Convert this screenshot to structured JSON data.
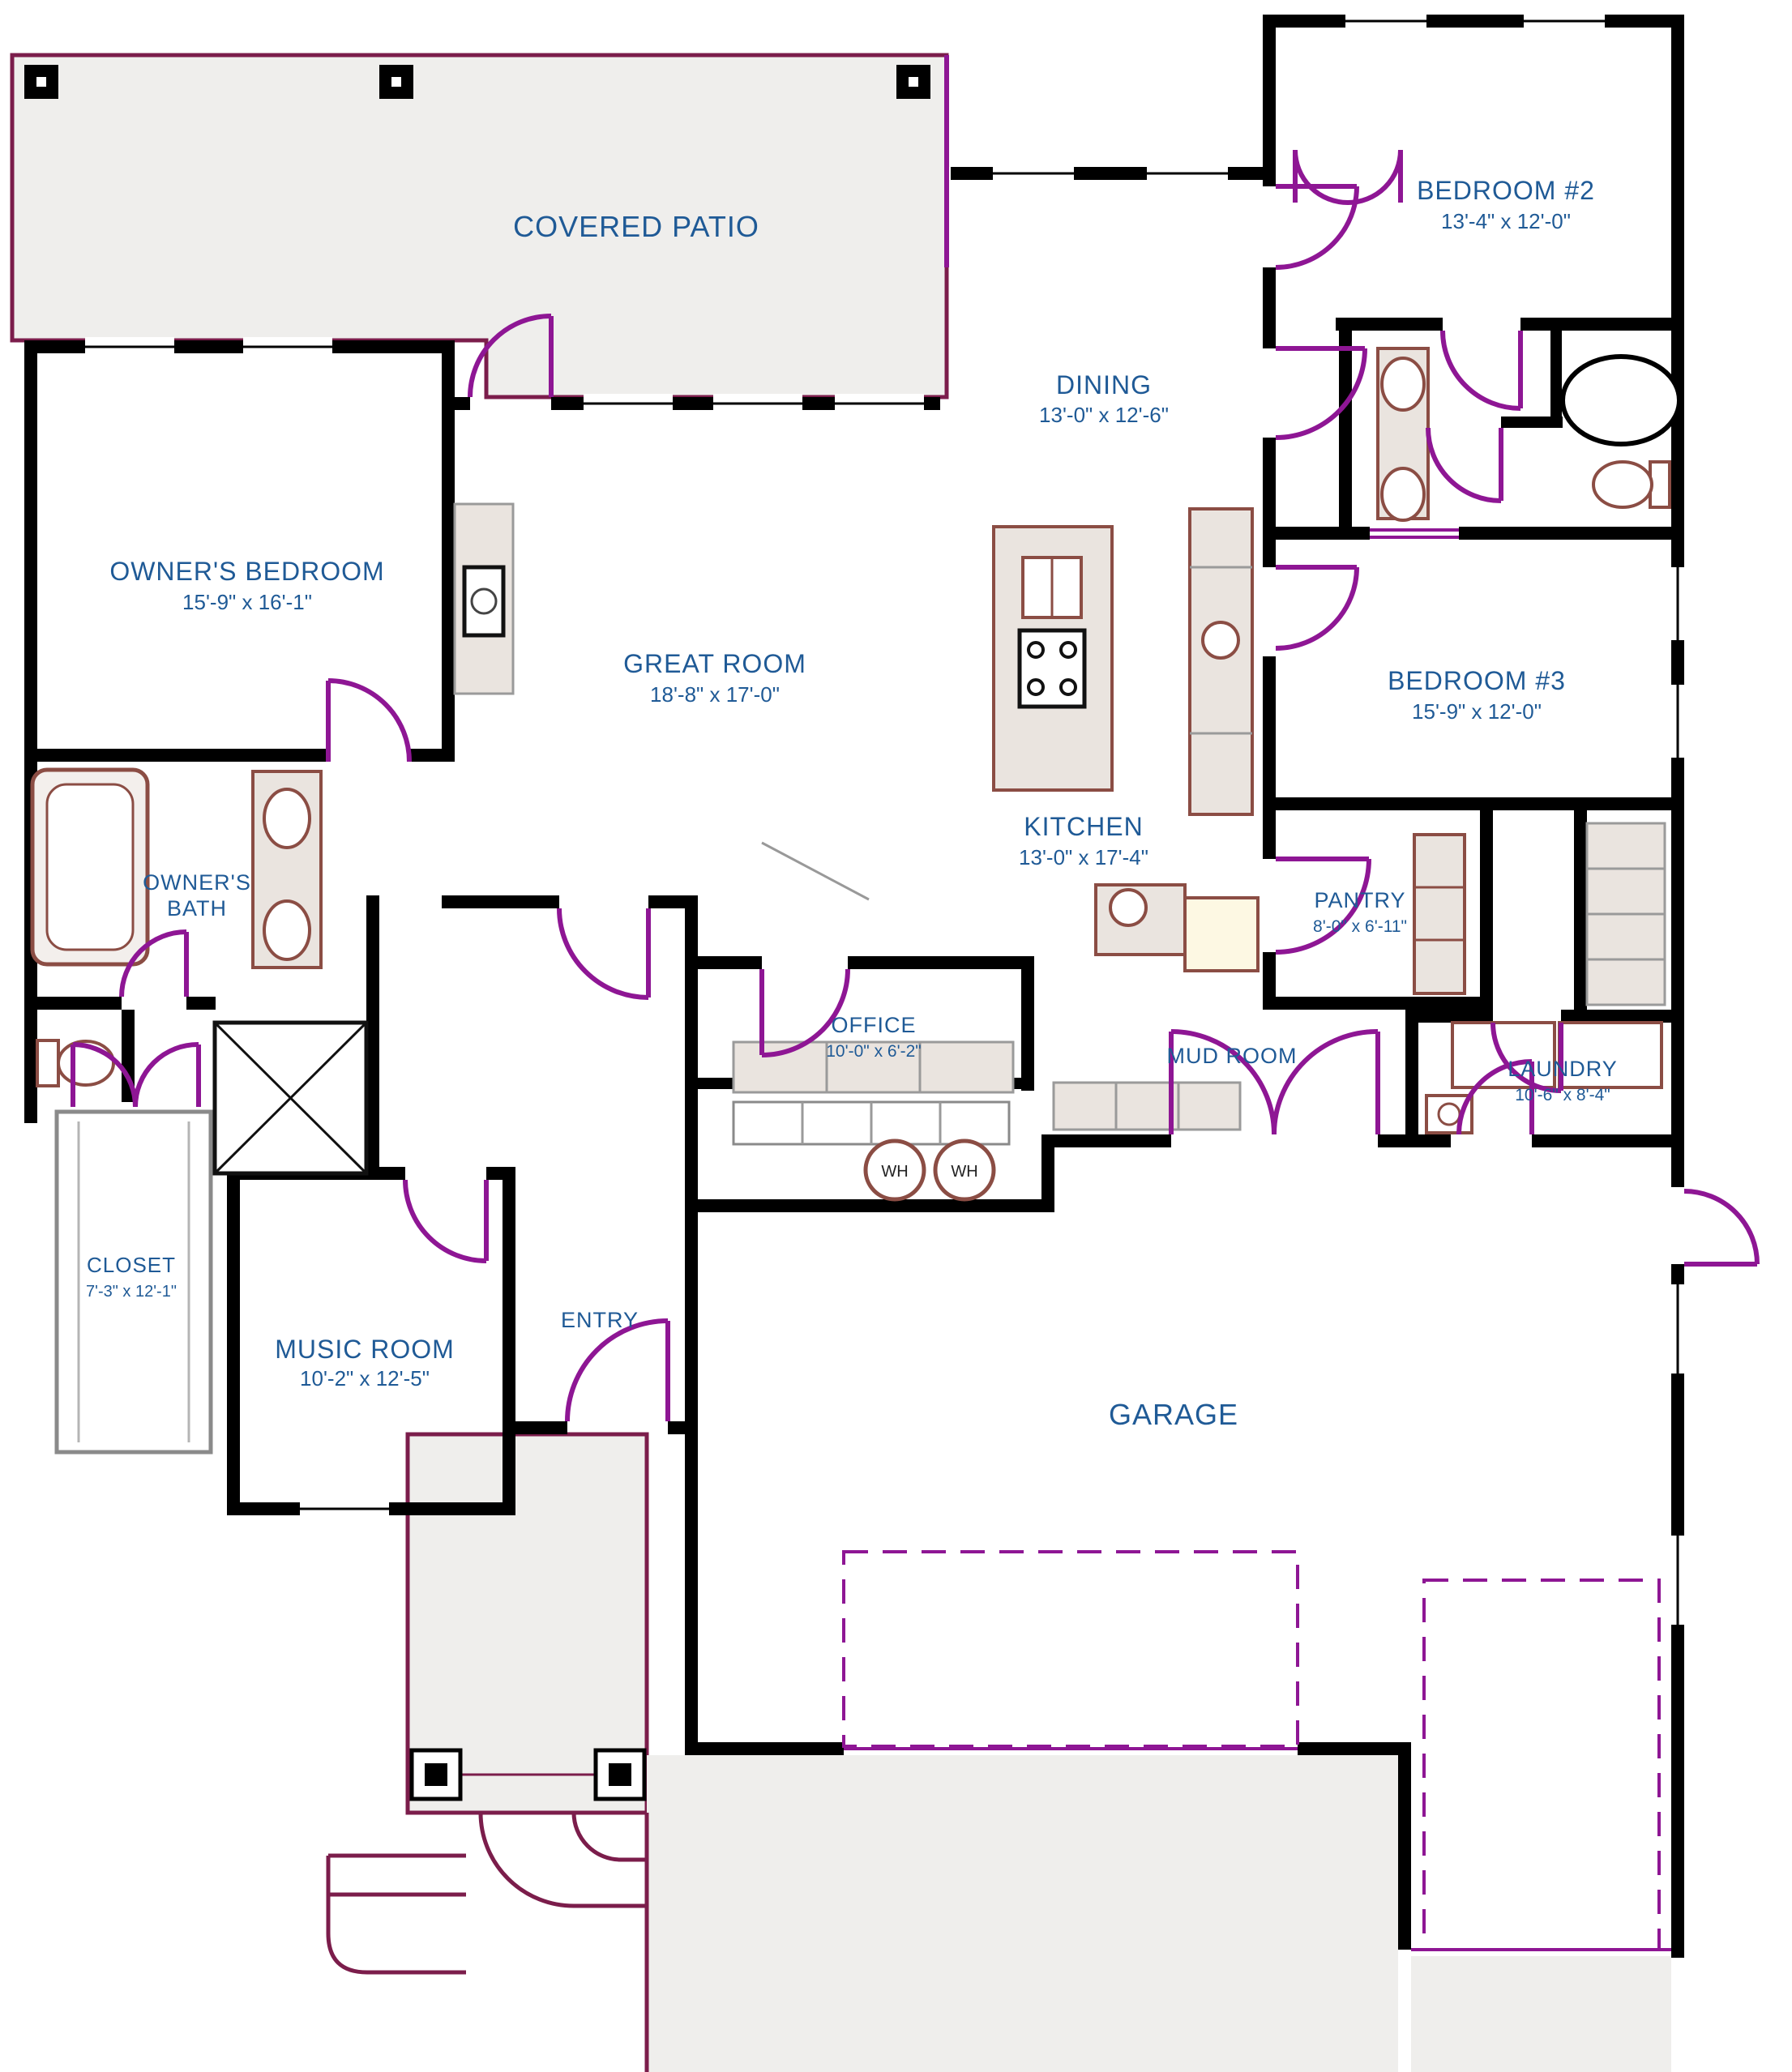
{
  "plan_title": "Single-story residence floor plan",
  "colors": {
    "label_blue": "#1f5a96",
    "wall_black": "#000000",
    "door_purple": "#8e1694",
    "flatwork_maroon": "#7b1d4b",
    "fixture_brown": "#8b4d44",
    "flatwork_gray": "#efeeec"
  },
  "rooms": {
    "covered_patio": {
      "name": "COVERED PATIO"
    },
    "bedroom2": {
      "name": "BEDROOM #2",
      "dims": "13'-4\" x 12'-0\""
    },
    "dining": {
      "name": "DINING",
      "dims": "13'-0\" x 12'-6\""
    },
    "owners_bedroom": {
      "name": "OWNER'S BEDROOM",
      "dims": "15'-9\" x 16'-1\""
    },
    "great_room": {
      "name": "GREAT ROOM",
      "dims": "18'-8\" x 17'-0\""
    },
    "bedroom3": {
      "name": "BEDROOM #3",
      "dims": "15'-9\" x 12'-0\""
    },
    "kitchen": {
      "name": "KITCHEN",
      "dims": "13'-0\" x 17'-4\""
    },
    "owners_bath": {
      "line1": "OWNER'S",
      "line2": "BATH"
    },
    "pantry": {
      "name": "PANTRY",
      "dims": "8'-0\" x 6'-11\""
    },
    "office": {
      "name": "OFFICE",
      "dims": "10'-0\" x 6'-2\""
    },
    "mud_room": {
      "name": "MUD ROOM"
    },
    "laundry": {
      "name": "LAUNDRY",
      "dims": "10'-6\" x 8'-4\""
    },
    "closet": {
      "name": "CLOSET",
      "dims": "7'-3\" x 12'-1\""
    },
    "music_room": {
      "name": "MUSIC ROOM",
      "dims": "10'-2\" x 12'-5\""
    },
    "entry": {
      "name": "ENTRY"
    },
    "garage": {
      "name": "GARAGE"
    }
  },
  "fixtures": {
    "water_heater_left": "WH",
    "water_heater_right": "WH"
  }
}
